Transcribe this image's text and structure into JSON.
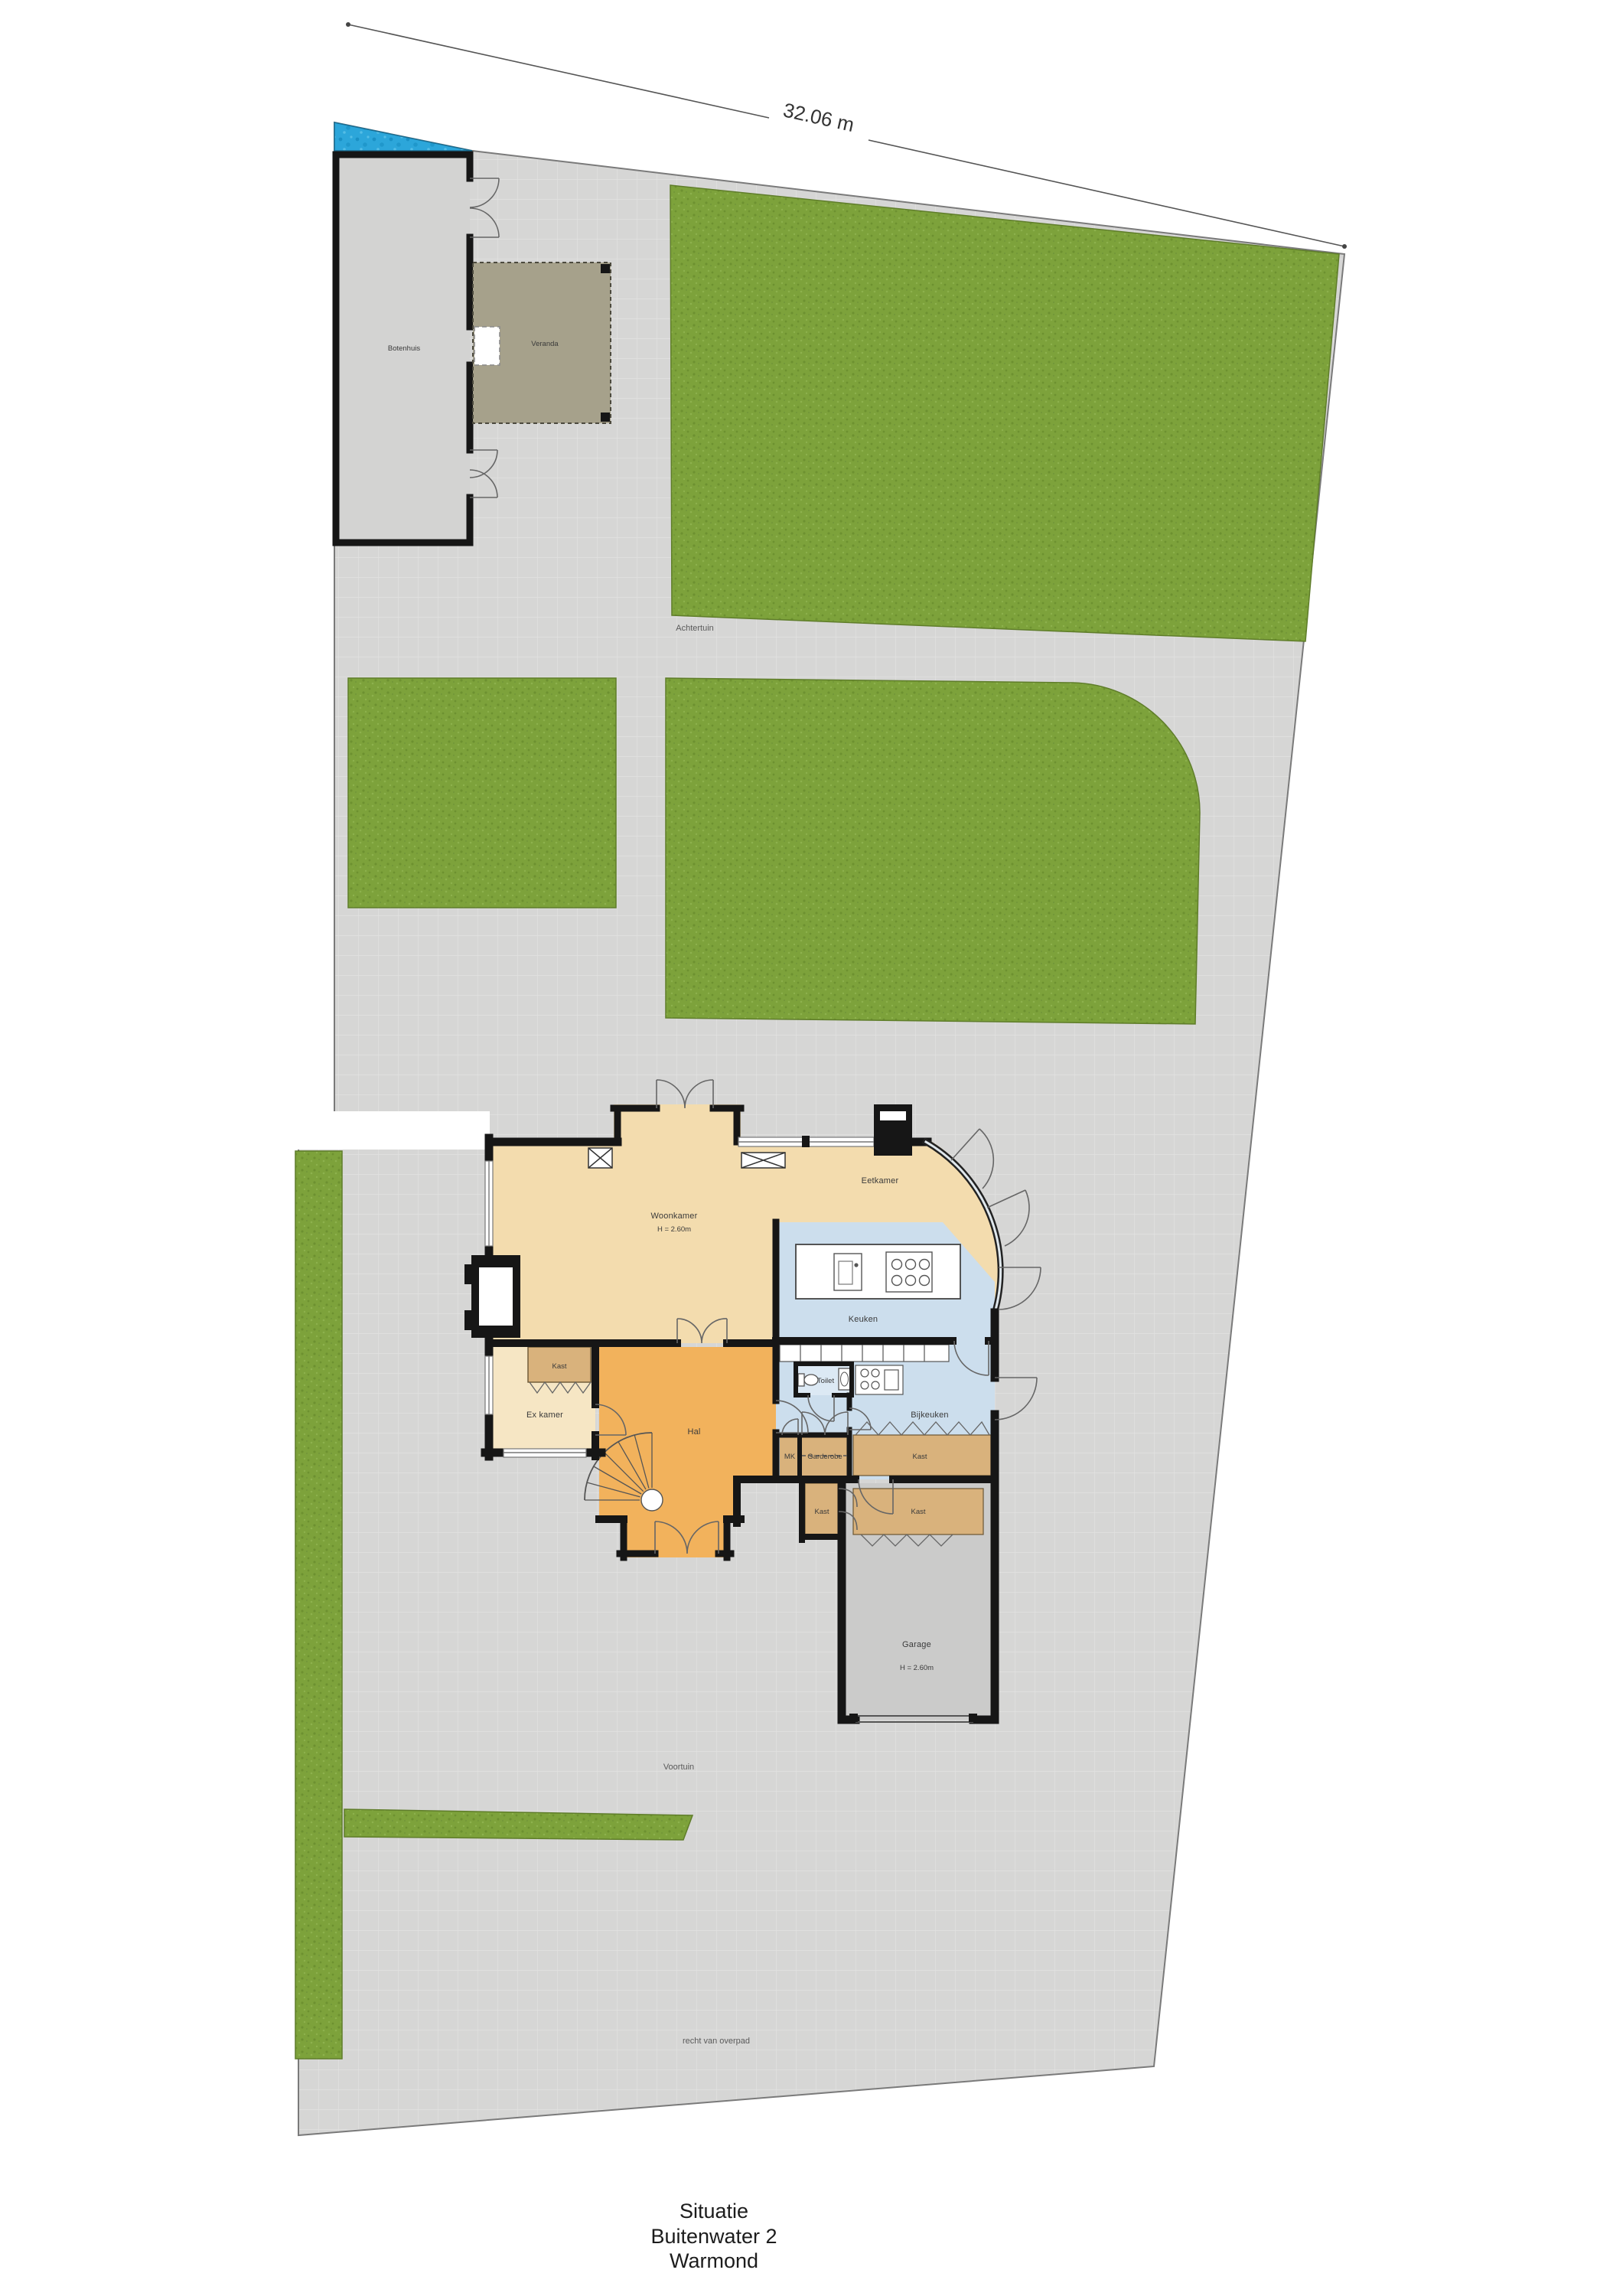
{
  "dimension": {
    "width_label": "32.06 m"
  },
  "outbuilding": {
    "botenhuis_label": "Botenhuis",
    "veranda_label": "Veranda"
  },
  "garden": {
    "achtertuin_label": "Achtertuin",
    "voortuin_label": "Voortuin",
    "easement_label": "recht van overpad"
  },
  "house": {
    "woonkamer": {
      "label": "Woonkamer",
      "height": "H = 2.60m"
    },
    "eetkamer": {
      "label": "Eetkamer"
    },
    "ex_kamer": {
      "label": "Ex kamer"
    },
    "keuken": {
      "label": "Keuken"
    },
    "bijkeuken": {
      "label": "Bijkeuken"
    },
    "toilet": {
      "label": "Toilet"
    },
    "hal": {
      "label": "Hal"
    },
    "mk": {
      "label": "MK"
    },
    "garderobe": {
      "label": "Garderobe"
    },
    "kast": {
      "label": "Kast"
    },
    "garage": {
      "label": "Garage",
      "height": "H = 2.60m"
    }
  },
  "title_block": {
    "line1": "Situatie",
    "line2": "Buitenwater 2",
    "line3": "Warmond"
  },
  "colors": {
    "paving": "#d6d6d5",
    "grass": "#7da23b",
    "water": "#2ca6da",
    "living_beige": "#f3dcae",
    "front_room_beige": "#f6e6c4",
    "hall_orange": "#f2b25c",
    "kitchen_blue": "#ccdeed",
    "closet_tan": "#d9b27c",
    "garage_gray": "#cbcbca",
    "veranda_olive": "#a6a18b",
    "wall_black": "#161616"
  }
}
